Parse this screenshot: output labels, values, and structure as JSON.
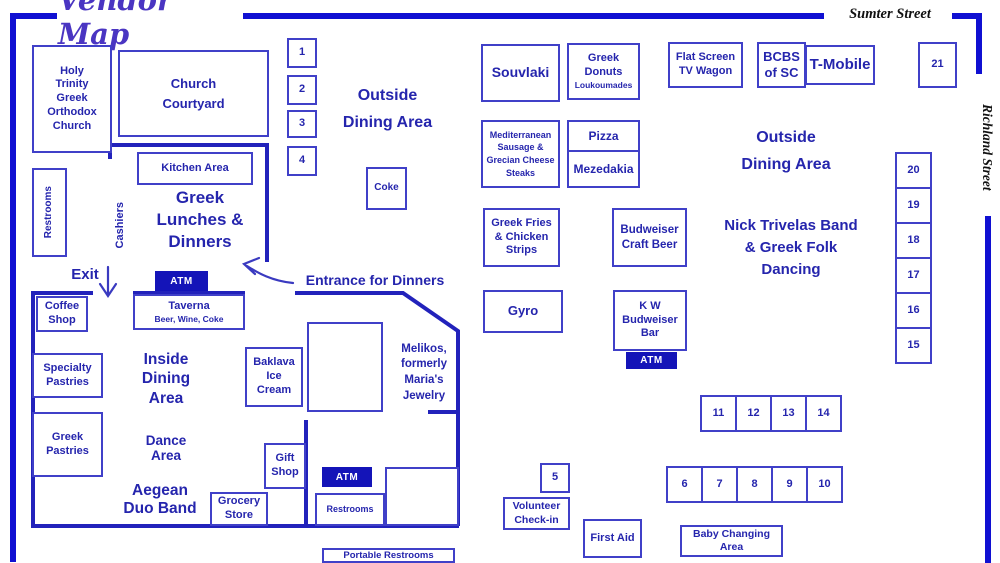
{
  "title": "Vendor Map",
  "streets": {
    "top": "Sumter Street",
    "right": "Richland Street"
  },
  "areas": {
    "outside_dining_left": "Outside\nDining Area",
    "outside_dining_right": "Outside\nDining Area",
    "greek_lunches": "Greek\nLunches &\nDinners",
    "inside_dining": "Inside\nDining\nArea",
    "dance_area": "Dance\nArea",
    "aegean_duo_band": "Aegean\nDuo Band",
    "nick_trivelas": "Nick Trivelas Band\n& Greek Folk\nDancing",
    "melikos": "Melikos,\nformerly\nMaria's\nJewelry",
    "exit": "Exit",
    "entrance_for_dinners": "Entrance for Dinners",
    "cashiers": "Cashiers"
  },
  "vendors": {
    "holy_trinity": "Holy\nTrinity\nGreek\nOrthodox\nChurch",
    "church_courtyard": "Church\nCourtyard",
    "kitchen_area": "Kitchen Area",
    "restrooms": "Restrooms",
    "coke": "Coke",
    "coffee_shop": "Coffee\nShop",
    "taverna": "Taverna",
    "taverna_sub": "Beer, Wine, Coke",
    "specialty_pastries": "Specialty\nPastries",
    "greek_pastries": "Greek\nPastries",
    "grocery_store": "Grocery\nStore",
    "gift_shop": "Gift\nShop",
    "baklava_ice_cream": "Baklava\nIce\nCream",
    "portable_restrooms": "Portable Restrooms",
    "souvlaki": "Souvlaki",
    "greek_donuts": "Greek\nDonuts",
    "greek_donuts_sub": "Loukoumades",
    "flat_screen": "Flat Screen\nTV Wagon",
    "bcbs": "BCBS\nof SC",
    "tmobile": "T-Mobile",
    "mediterranean": "Mediterranean\nSausage &\nGrecian Cheese\nSteaks",
    "pizza": "Pizza",
    "mezedakia": "Mezedakia",
    "greek_fries": "Greek Fries\n& Chicken\nStrips",
    "budweiser_craft": "Budweiser\nCraft Beer",
    "gyro": "Gyro",
    "kw_budweiser_bar": "K W\nBudweiser\nBar",
    "volunteer_checkin": "Volunteer\nCheck-in",
    "first_aid": "First Aid",
    "baby_changing": "Baby Changing\nArea",
    "atm": "ATM"
  },
  "stalls": [
    "1",
    "2",
    "3",
    "4",
    "5",
    "6",
    "7",
    "8",
    "9",
    "10",
    "11",
    "12",
    "13",
    "14",
    "15",
    "16",
    "17",
    "18",
    "19",
    "20",
    "21"
  ],
  "colors": {
    "ink": "#2525ad",
    "box_border": "#4040c8",
    "wall": "#2222bb",
    "street_line": "#1010d2",
    "atm_bg": "#1414b8",
    "title": "#4a35c2",
    "street_text": "#111111"
  }
}
